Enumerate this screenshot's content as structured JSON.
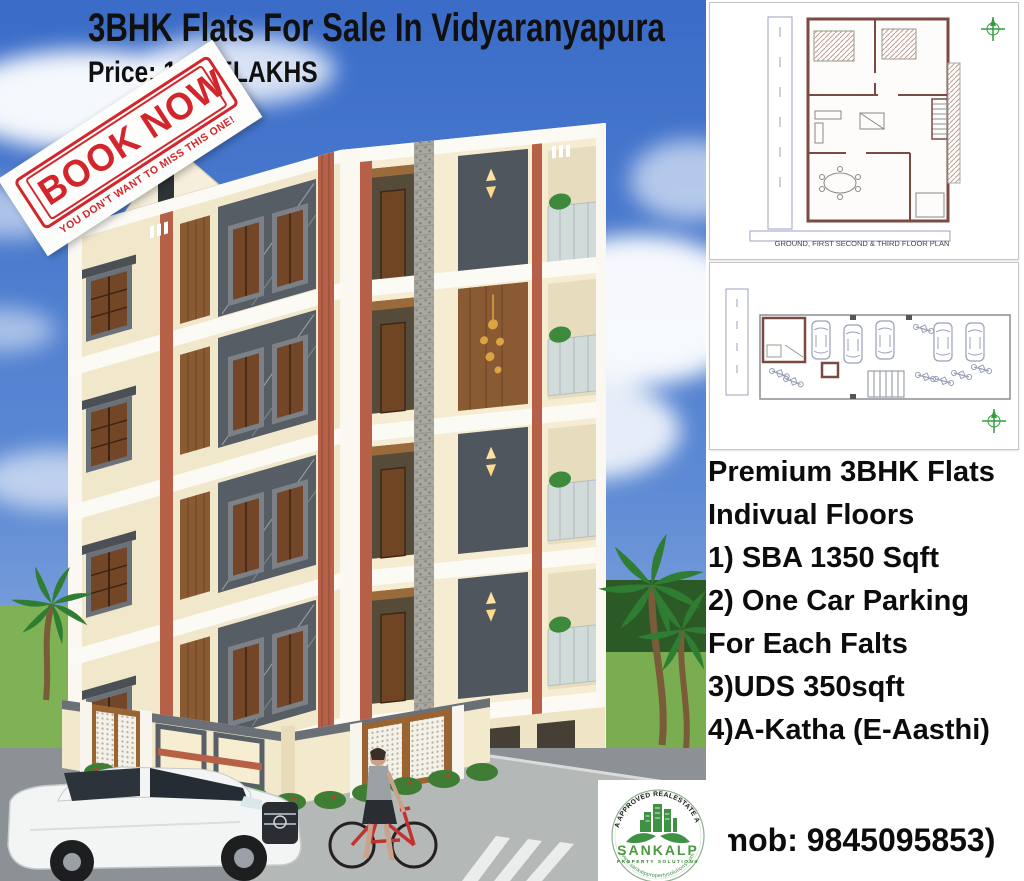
{
  "header": {
    "title": "3BHK Flats For Sale In Vidyaranyapura",
    "price": "Price: 1CR 5LAKHS"
  },
  "stamp": {
    "title": "BOOK NOW",
    "tagline": "YOU DON'T WANT TO MISS THIS ONE!"
  },
  "plans": {
    "floor_plan_caption": "GROUND, FIRST SECOND & THIRD FLOOR PLAN"
  },
  "features": {
    "lines": [
      "Premium 3BHK Flats",
      "Indivual Floors",
      "1) SBA 1350 Sqft",
      "2) One Car Parking",
      "For Each Falts",
      "3)UDS 350sqft",
      "4)A-Katha (E-Aasthi)"
    ]
  },
  "contact": {
    "mobile": "(mob: 9845095853)"
  },
  "logo": {
    "arc_top": "RERA APPROVED REALESTATE AGENT",
    "name": "SANKALP",
    "subtitle": "PROPERTY SOLUTIONS",
    "arc_bottom": "www.sankalppropertysolutions.com"
  },
  "colors": {
    "sky_blue": "#3a6cc8",
    "wall_cream": "#f2e8cc",
    "terracotta": "#b66147",
    "panel_gray": "#565c64",
    "stamp_red": "#d3262c",
    "logo_green": "#3f9143",
    "text_black": "#101010"
  }
}
